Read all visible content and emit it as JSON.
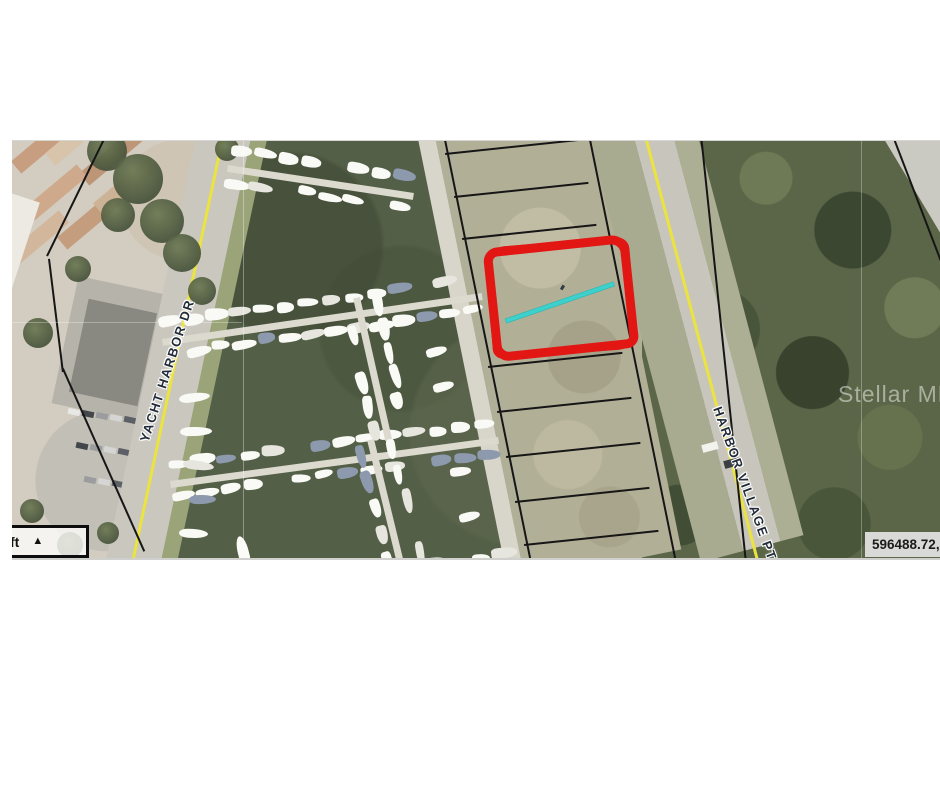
{
  "map": {
    "road_labels": [
      {
        "id": "yacht-harbor-dr",
        "text": "YACHT HARBOR DR"
      },
      {
        "id": "harbor-village-pt",
        "text": "HARBOR VILLAGE PT"
      }
    ],
    "watermark": "Stellar MLS",
    "scale_bar": {
      "unit_label": "ft",
      "collapse_arrow": "▲"
    },
    "coordinate_readout": "596488.72, 1",
    "annotation_colors": {
      "parcel_highlight": "#e21613",
      "measurement_line": "#3ed0cb",
      "road_centerline": "#ece43e"
    }
  }
}
